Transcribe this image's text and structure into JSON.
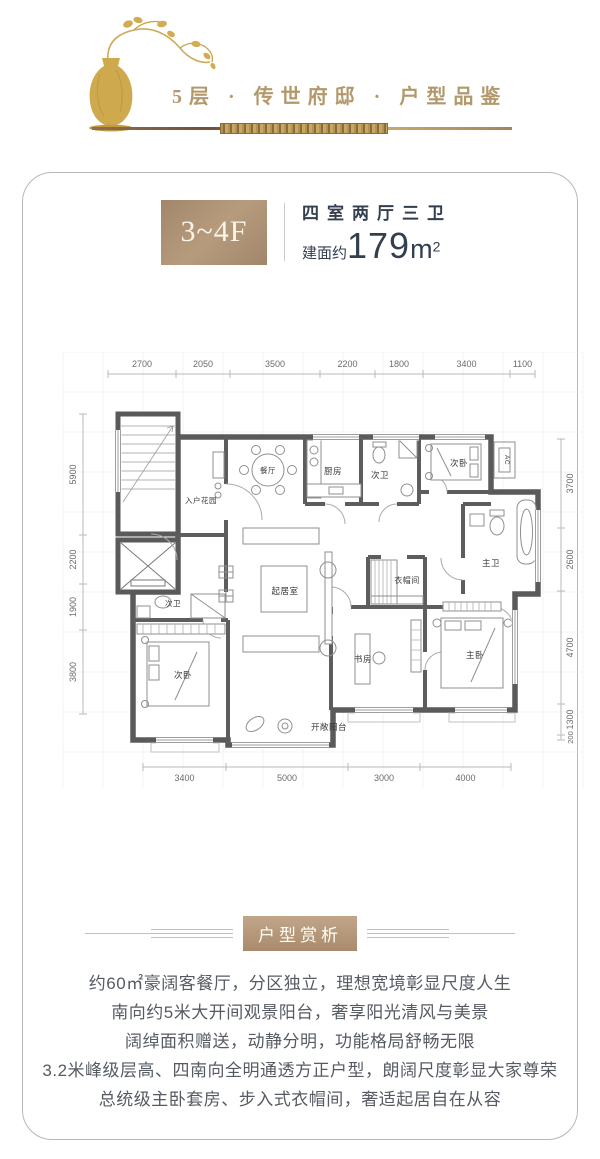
{
  "header": {
    "title": "5层 · 传世府邸 · 户型品鉴"
  },
  "card": {
    "floor_badge": "3~4F",
    "layout_type": "四室两厅三卫",
    "area_prefix": "建面约",
    "area_value": "179",
    "area_unit": "m",
    "area_sup": "2"
  },
  "floor_plan": {
    "dims_top": [
      "2700",
      "2050",
      "3500",
      "2200",
      "1800",
      "3400",
      "1100"
    ],
    "dims_bottom": [
      "3400",
      "5000",
      "3000",
      "4000"
    ],
    "dims_left": [
      "5900",
      "2200",
      "1900",
      "3800"
    ],
    "dims_right": [
      "3700",
      "2600",
      "4700",
      "1300",
      "200"
    ],
    "rooms": {
      "entry": "入户花园",
      "dining": "餐厅",
      "kitchen": "厨房",
      "bath2_top": "次卫",
      "bed2_top": "次卧",
      "ac": "AC",
      "master_bath": "主卫",
      "closet": "衣帽间",
      "living": "起居室",
      "study": "书房",
      "master_bed": "主卧",
      "bath2_left": "次卫",
      "bed2_left": "次卧",
      "balcony": "开敞阳台"
    }
  },
  "section": {
    "badge": "户型赏析"
  },
  "description": {
    "lines": [
      "约60㎡豪阔客餐厅，分区独立，理想宽境彰显尺度人生",
      "南向约5米大开间观景阳台，奢享阳光清风与美景",
      "阔绰面积赠送，动静分明，功能格局舒畅无限",
      "3.2米峰级层高、四南向全明通透方正户型，朗阔尺度彰显大家尊荣",
      "总统级主卧套房、步入式衣帽间，奢适起居自在从容"
    ]
  }
}
